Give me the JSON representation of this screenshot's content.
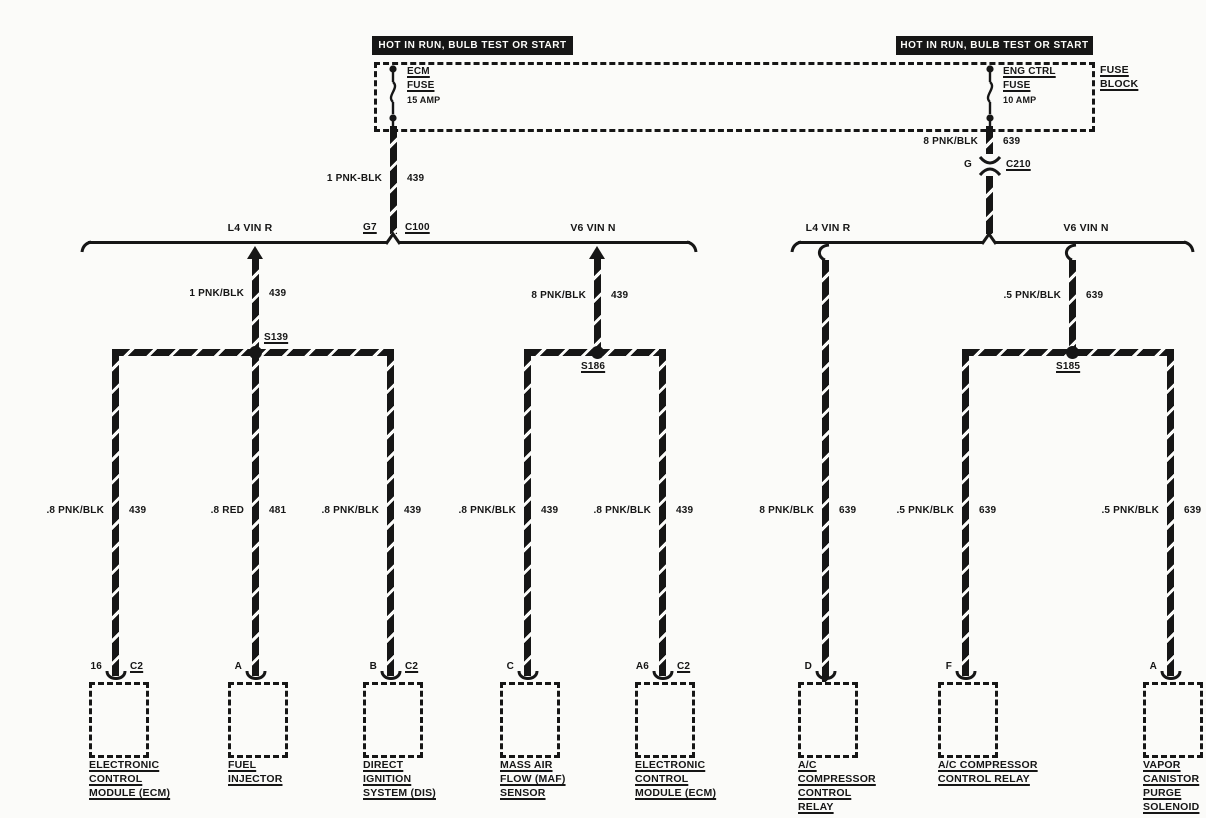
{
  "diagram": {
    "headers": [
      {
        "text": "HOT IN RUN, BULB TEST OR START"
      },
      {
        "text": "HOT IN RUN, BULB TEST OR START"
      }
    ],
    "fuse_block": {
      "label_line1": "FUSE",
      "label_line2": "BLOCK",
      "fuses": [
        {
          "name_line1": "ECM",
          "name_line2": "FUSE",
          "rating": "15 AMP"
        },
        {
          "name_line1": "ENG CTRL",
          "name_line2": "FUSE",
          "rating": "10 AMP"
        }
      ]
    },
    "connectors": [
      {
        "pin": "G7",
        "id": "C100"
      },
      {
        "pin": "G",
        "id": "C210"
      }
    ],
    "branches": {
      "left": [
        {
          "label": "L4 VIN R"
        },
        {
          "label": "V6 VIN N"
        }
      ],
      "right": [
        {
          "label": "L4 VIN R"
        },
        {
          "label": "V6 VIN N"
        }
      ]
    },
    "splices": [
      {
        "id": "S139"
      },
      {
        "id": "S186"
      },
      {
        "id": "S185"
      }
    ],
    "wire_labels": [
      {
        "gauge": "1 PNK-BLK",
        "circuit": "439"
      },
      {
        "gauge": "8 PNK/BLK",
        "circuit": "639"
      },
      {
        "gauge": "1 PNK/BLK",
        "circuit": "439"
      },
      {
        "gauge": "8 PNK/BLK",
        "circuit": "439"
      },
      {
        "gauge": ".5 PNK/BLK",
        "circuit": "639"
      },
      {
        "gauge": ".8 PNK/BLK",
        "circuit": "439"
      },
      {
        "gauge": ".8 RED",
        "circuit": "481"
      },
      {
        "gauge": ".8 PNK/BLK",
        "circuit": "439"
      },
      {
        "gauge": ".8 PNK/BLK",
        "circuit": "439"
      },
      {
        "gauge": ".8 PNK/BLK",
        "circuit": "439"
      },
      {
        "gauge": "8 PNK/BLK",
        "circuit": "639"
      },
      {
        "gauge": ".5 PNK/BLK",
        "circuit": "639"
      },
      {
        "gauge": ".5 PNK/BLK",
        "circuit": "639"
      }
    ],
    "components": [
      {
        "pin": "16",
        "connector": "C2",
        "lines": [
          "ELECTRONIC",
          "CONTROL",
          "MODULE (ECM)"
        ]
      },
      {
        "pin": "A",
        "lines": [
          "FUEL",
          "INJECTOR"
        ]
      },
      {
        "pin": "B",
        "connector": "C2",
        "lines": [
          "DIRECT",
          "IGNITION",
          "SYSTEM (DIS)"
        ]
      },
      {
        "pin": "C",
        "lines": [
          "MASS AIR",
          "FLOW (MAF)",
          "SENSOR"
        ]
      },
      {
        "pin": "A6",
        "connector": "C2",
        "lines": [
          "ELECTRONIC",
          "CONTROL",
          "MODULE (ECM)"
        ]
      },
      {
        "pin": "D",
        "lines": [
          "A/C",
          "COMPRESSOR",
          "CONTROL",
          "RELAY"
        ]
      },
      {
        "pin": "F",
        "lines": [
          "A/C COMPRESSOR",
          "CONTROL RELAY"
        ]
      },
      {
        "pin": "A",
        "lines": [
          "VAPOR",
          "CANISTOR",
          "PURGE",
          "SOLENOID"
        ]
      }
    ]
  }
}
